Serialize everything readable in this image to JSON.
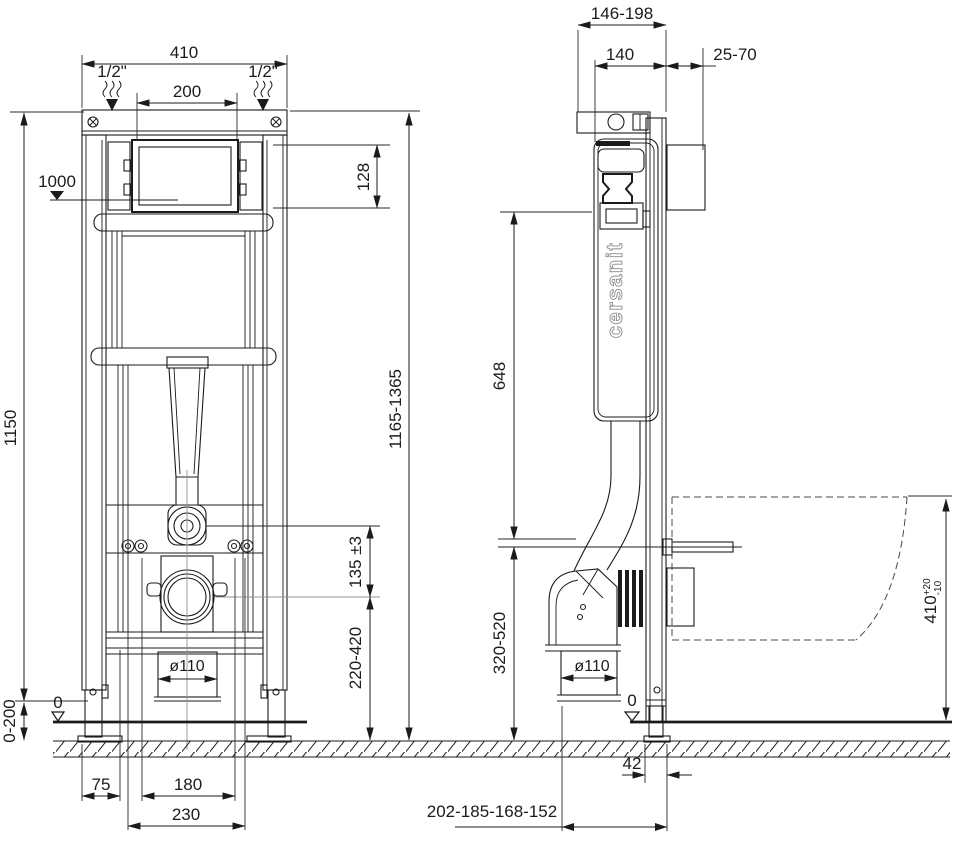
{
  "drawing": {
    "brand_logo": "cersanit",
    "front_view": {
      "width_total": "410",
      "inlet_left": "1/2\"",
      "inlet_right": "1/2\"",
      "window_width": "200",
      "window_height": "128",
      "supply_level": "1000",
      "frame_height": "1150",
      "install_height": "1165-1365",
      "inlet_to_outlet": "135 ±3",
      "outlet_height": "220-420",
      "drain_diameter": "ø110",
      "floor_level": "0",
      "leg_adjustment": "0-200",
      "foot_offset": "75",
      "bowl_bolt_spacing": "180",
      "fixing_spacing": "230"
    },
    "side_view": {
      "depth_range": "146-198",
      "frame_depth": "140",
      "anchor_depth": "25-70",
      "tank_height": "648",
      "outlet_height": "320-520",
      "drain_diameter": "ø110",
      "floor_level": "0",
      "leg_offset": "42",
      "outlet_distances": "202-185-168-152",
      "bowl_top_height": "410",
      "bowl_top_tol_plus": "+20",
      "bowl_top_tol_minus": "-10"
    }
  },
  "colors": {
    "line": "#1b1b1b",
    "background": "#ffffff",
    "accent_gray": "#949494"
  }
}
